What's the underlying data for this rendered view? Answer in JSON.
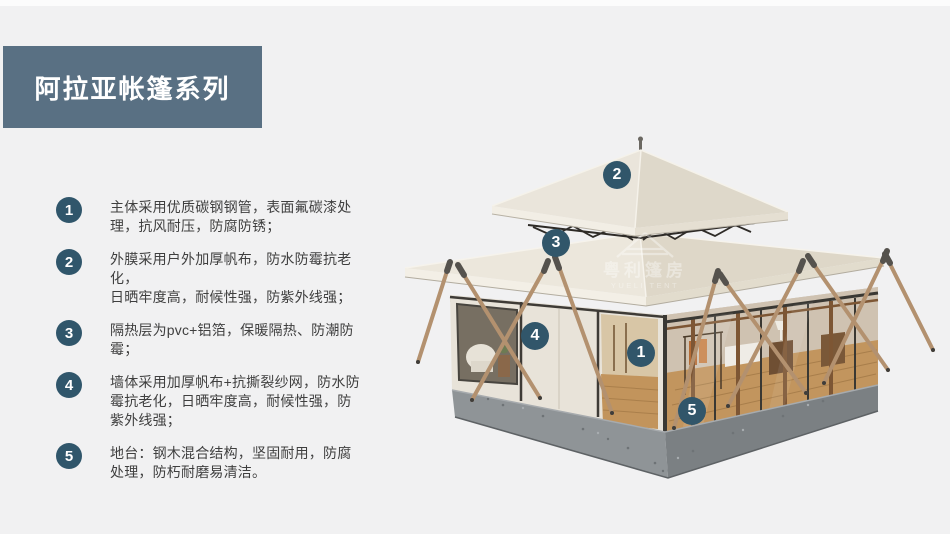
{
  "title": "阿拉亚帐篷系列",
  "features": [
    {
      "num": "1",
      "text": "主体采用优质碳钢钢管，表面氟碳漆处\n理，抗风耐压，防腐防锈；"
    },
    {
      "num": "2",
      "text": "外膜采用户外加厚帆布，防水防霉抗老化，\n日晒牢度高，耐候性强，防紫外线强；"
    },
    {
      "num": "3",
      "text": "隔热层为pvc+铝箔，保暖隔热、防潮防\n霉；"
    },
    {
      "num": "4",
      "text": "墙体采用加厚帆布+抗撕裂纱网，防水防\n霉抗老化，日晒牢度高，耐候性强，防\n紫外线强；"
    },
    {
      "num": "5",
      "text": "地台：钢木混合结构，坚固耐用，防腐\n处理，防朽耐磨易清洁。"
    }
  ],
  "callouts": [
    {
      "label": "1"
    },
    {
      "label": "2"
    },
    {
      "label": "3"
    },
    {
      "label": "4"
    },
    {
      "label": "5"
    }
  ],
  "watermark": {
    "cn": "粤利篷房",
    "en": "YUELI TENT"
  },
  "colors": {
    "banner_bg": "#597083",
    "badge_bg": "#30566b",
    "page_bg": "#f1f1f2",
    "body_text": "#3f3f3f",
    "roof_canvas": "#eae5db",
    "pole_wood": "#b3916f",
    "base_gray": "#8f9497"
  }
}
